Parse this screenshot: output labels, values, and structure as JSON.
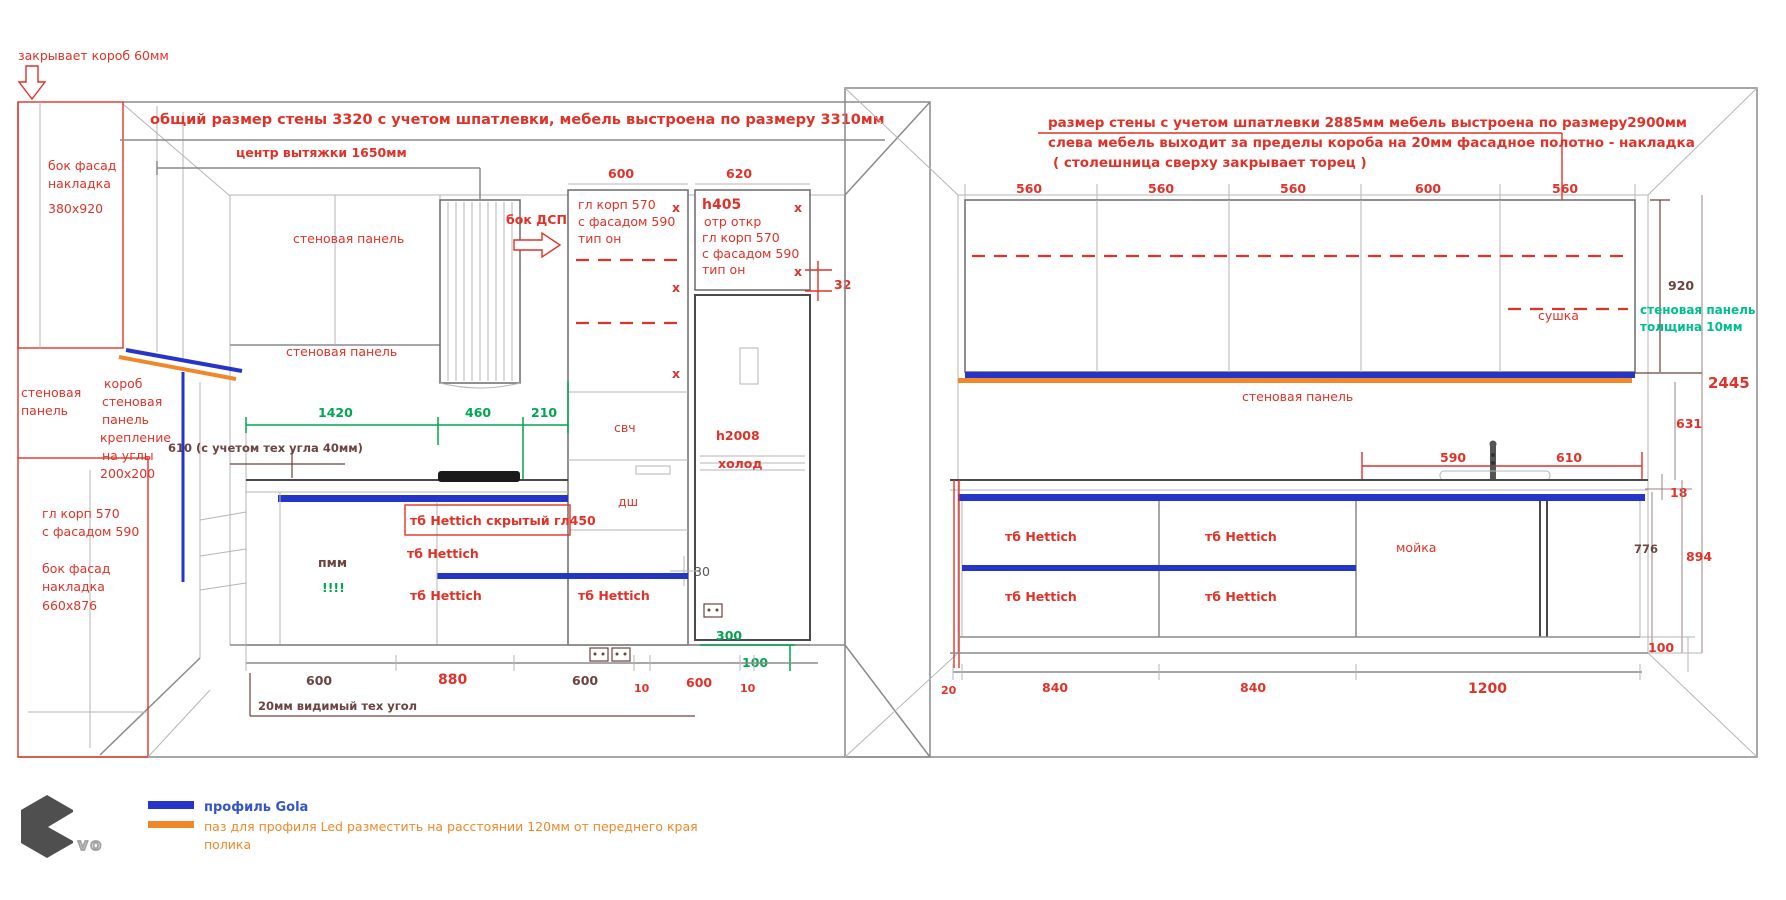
{
  "colors": {
    "annotation_red": "#e03228",
    "dim_dark": "#6b4340",
    "dim_green": "#00a651",
    "panel_teal": "#00bf8f",
    "gola_blue": "#2535c8",
    "led_orange": "#f0882a",
    "line_gray": "#8a8a8a"
  },
  "left": {
    "callout_top": "закрывает короб 60мм",
    "side_panel": [
      "бок фасад",
      "накладка",
      "380x920"
    ],
    "title": "общий размер стены 3320 с учетом шпатлевки, мебель выстроена по размеру 3310мм",
    "hood_center": "центр вытяжки 1650мм",
    "top_dims": [
      "600",
      "620"
    ],
    "wall_panel": "стеновая панель",
    "bok_dsp": "бок ДСП",
    "cab_a": [
      "гл корп 570",
      "с фасадом 590",
      "тип он"
    ],
    "x": "x",
    "cab_b": [
      "h405",
      "отр откр",
      "гл корп 570",
      "с фасадом 590",
      "тип он"
    ],
    "dim32": "32",
    "left_wall_panel": [
      "стеновая",
      "панель"
    ],
    "korob": [
      "короб",
      "стеновая",
      "панель",
      "крепление",
      "на углы",
      "200x200"
    ],
    "green_dims": [
      "1420",
      "460",
      "210"
    ],
    "note610": "610 (с учетом тех угла 40мм)",
    "svch": "свч",
    "dsh": "дш",
    "h2008": "h2008",
    "holod": "холод",
    "hettich_hidden": "тб Hettich скрытый гл450",
    "hettich": "тб Hettich",
    "pmm": "пмм",
    "exclaim": "!!!!",
    "dim30": "30",
    "dim300": "300",
    "dim100": "100",
    "bottom_dims": [
      "600",
      "880",
      "600",
      "10",
      "600",
      "10"
    ],
    "tech_note": "20мм видимый тех угол",
    "lower_cab": [
      "гл корп 570",
      "с фасадом 590"
    ],
    "lower_panel": [
      "бок фасад",
      "накладка",
      "660x876"
    ]
  },
  "right": {
    "title": [
      "размер стены с учетом шпатлевки 2885мм мебель выстроена по размеру2900мм",
      "слева мебель выходит за пределы короба на 20мм  фасадное полотно - накладка",
      "( столешница сверху закрывает торец )"
    ],
    "top_dims": [
      "560",
      "560",
      "560",
      "600",
      "560"
    ],
    "sushka": "сушка",
    "dim920": "920",
    "wall_panel_green": [
      "стеновая панель",
      "толщина 10мм"
    ],
    "dim2445": "2445",
    "dim631": "631",
    "wall_panel": "стеновая панель",
    "dim590": "590",
    "dim610": "610",
    "dim18": "18",
    "dim776": "776",
    "dim894": "894",
    "dim100": "100",
    "hettich": "тб Hettich",
    "moyka": "мойка",
    "bottom_dims": [
      "20",
      "840",
      "840",
      "1200"
    ]
  },
  "legend": {
    "gola": "профиль Gola",
    "led": [
      "паз для профиля Led разместить на расстоянии 120мм от переднего края",
      "полика"
    ],
    "logo": "VO"
  }
}
